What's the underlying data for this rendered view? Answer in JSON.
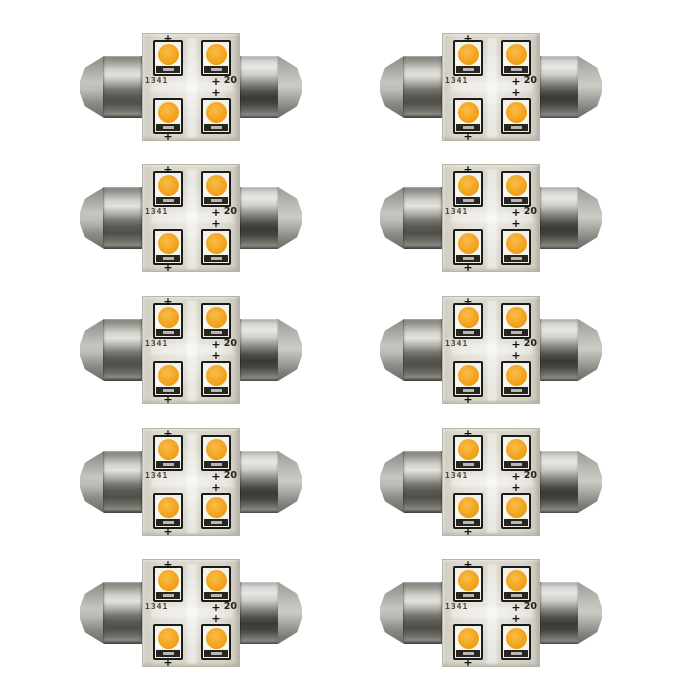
{
  "page": {
    "background": "#ffffff",
    "description": "Product photo: pack of 10 identical double-ended festoon LED bulbs, each with 4 amber SMD LEDs on a square PCB and chrome torpedo end caps"
  },
  "layout": {
    "rows": 5,
    "columns": 2,
    "bulb_count": 10
  },
  "bulb": {
    "pcb_marking_left": "1341",
    "pcb_marking_right": "20",
    "polarity_mark": "+",
    "led_count": 4,
    "colors": {
      "led_amber": "#f2a31c",
      "led_package_white": "#f7f5f0",
      "led_outline_black": "#1b1b17",
      "pcb_beige": "#d7d4c9",
      "cap_metal_light": "#e3e2de",
      "cap_metal_dark": "#454440",
      "background_white": "#ffffff"
    }
  }
}
